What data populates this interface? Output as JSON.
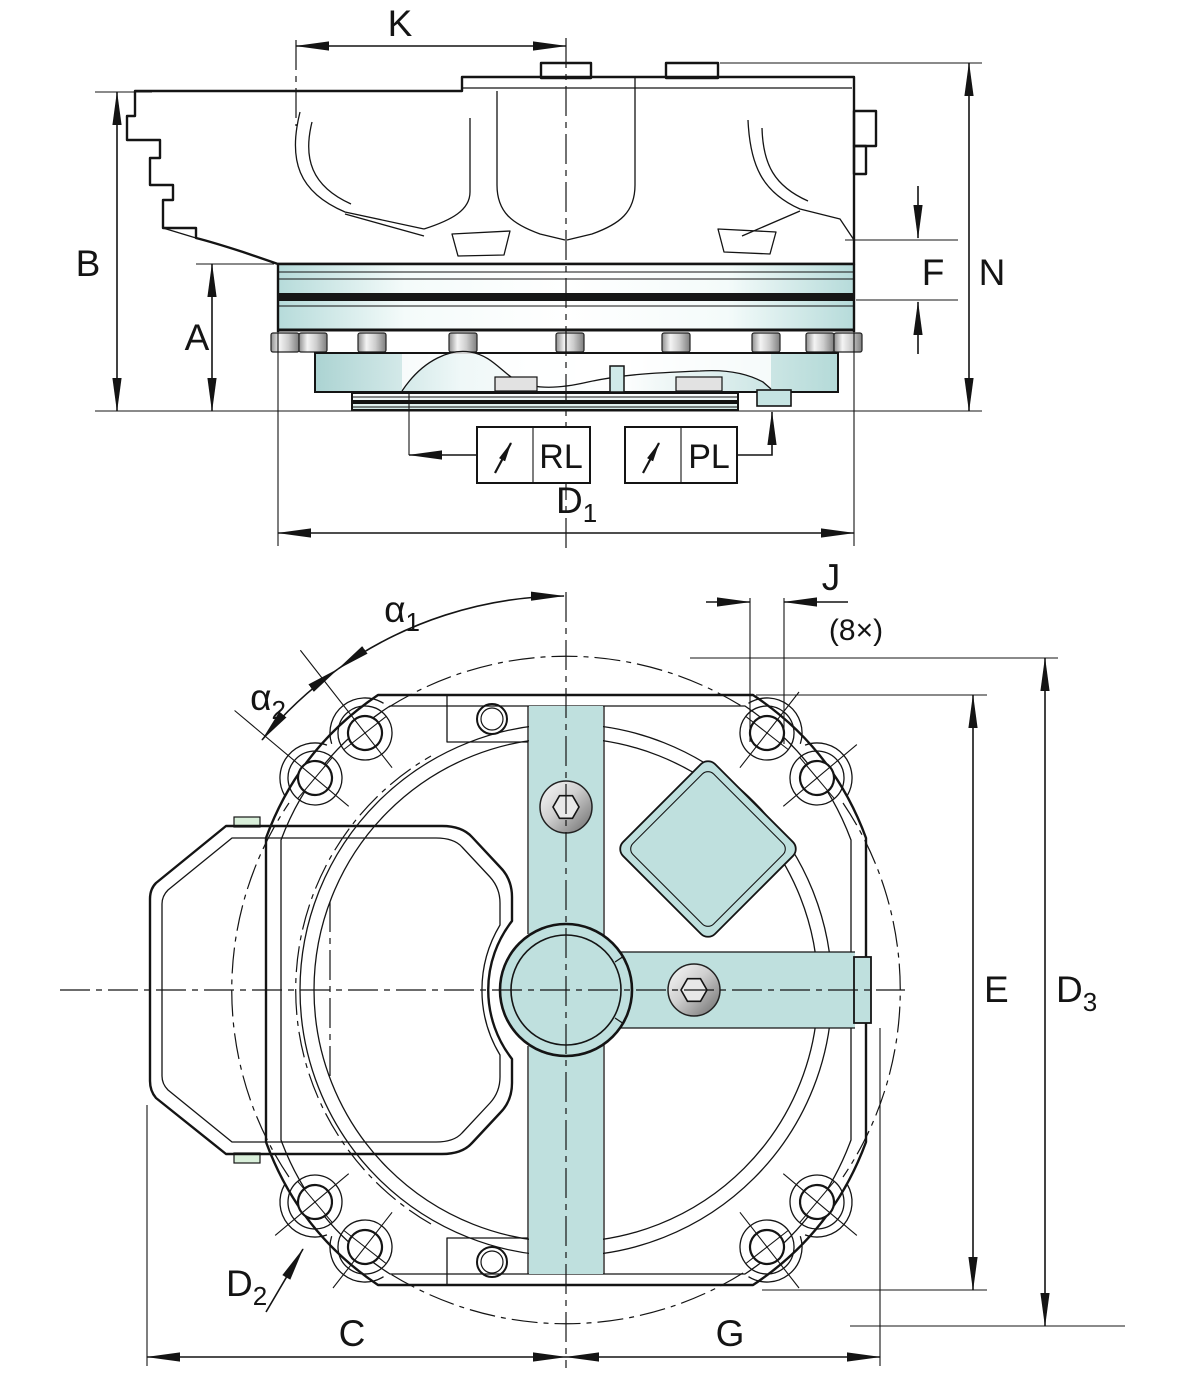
{
  "labels": {
    "k": "K",
    "b": "B",
    "a": "A",
    "f": "F",
    "n": "N",
    "d1": {
      "base": "D",
      "sub": "1"
    },
    "rl": "RL",
    "pl": "PL",
    "alpha1": {
      "base": "α",
      "sub": "1"
    },
    "alpha2": {
      "base": "α",
      "sub": "2"
    },
    "j": "J",
    "j_count": "(8×)",
    "e": "E",
    "d3": {
      "base": "D",
      "sub": "3"
    },
    "d2": {
      "base": "D",
      "sub": "2"
    },
    "c": "C",
    "g": "G"
  },
  "colors": {
    "body": "#c2e2e0",
    "body_edge": "#141414",
    "green_insert": "#d9efda",
    "metal_light": "#f2f2f2",
    "metal_dark": "#6a6a6a",
    "background": "#ffffff"
  }
}
